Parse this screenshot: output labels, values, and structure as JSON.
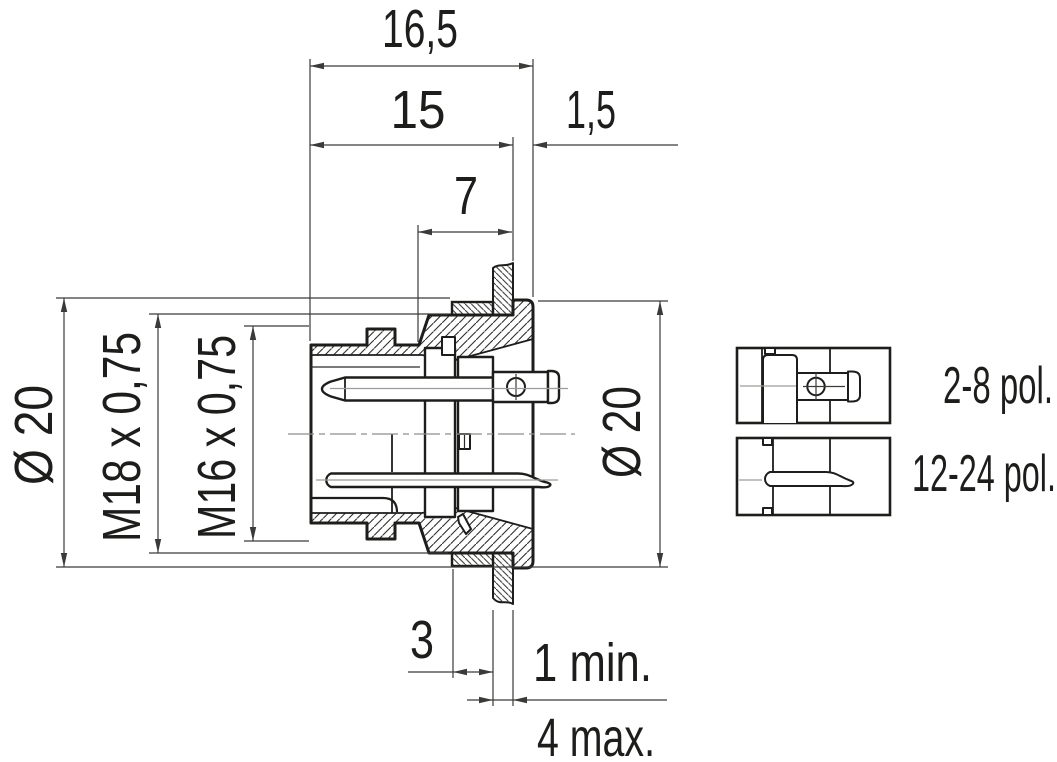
{
  "dims": {
    "overall_width": "16,5",
    "front_to_flange": "15",
    "flange_thickness": "1,5",
    "front_length": "7",
    "nut_thickness": "3",
    "panel_min": "1 min.",
    "panel_max": "4 max.",
    "dia_left": "Ø 20",
    "dia_right": "Ø 20",
    "thread_outer": "M18 x 0,75",
    "thread_inner": "M16 x 0,75"
  },
  "variants": {
    "pins_small": "2-8 pol.",
    "pins_large": "12-24 pol."
  },
  "colors": {
    "ink": "#1d1d1b",
    "thin_line": "#3a3a39",
    "center_line": "#9c9c9a",
    "background": "#ffffff"
  }
}
